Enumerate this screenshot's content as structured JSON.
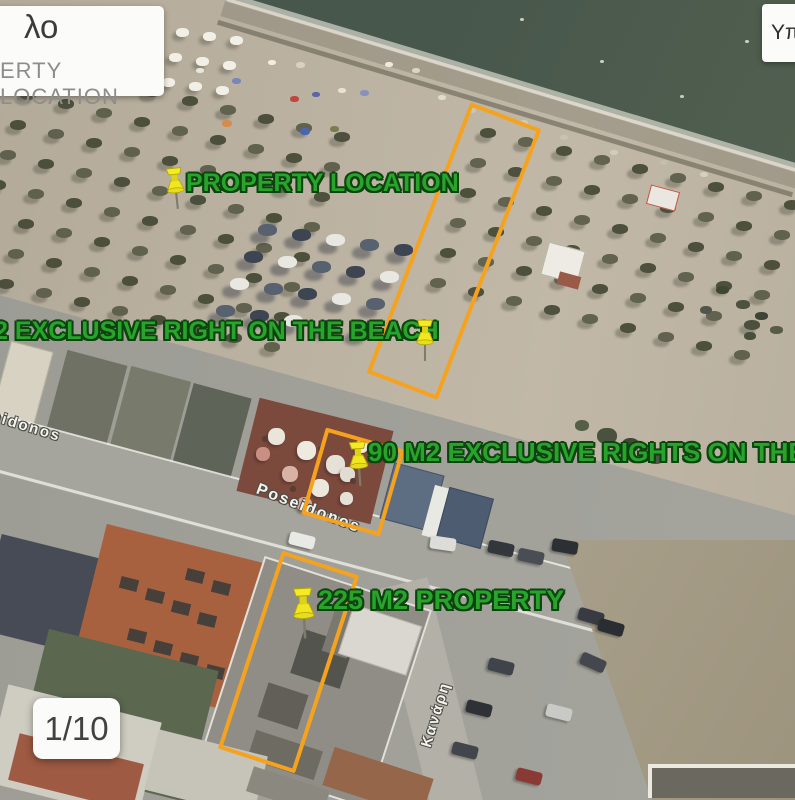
{
  "overlays": {
    "caption_box": {
      "line1": "λο",
      "line2": "ERTY LOCATION"
    },
    "legend_box": {
      "text": "Υπ"
    },
    "pager": {
      "text": "1/10"
    }
  },
  "annotations": {
    "accent_color": "#f5a31f",
    "text_color": "#28a32c",
    "labels": [
      {
        "text": "PROPERTY LOCATION"
      },
      {
        "text": "2 EXCLUSIVE RIGHT ON THE BEACH"
      },
      {
        "text": "90 M2 EXCLUSIVE RIGHTS ON THE"
      },
      {
        "text": "225 M2 PROPERTY"
      }
    ],
    "pins": [
      {
        "name": "property-location-pin"
      },
      {
        "name": "beach-rights-pin"
      },
      {
        "name": "beach-bar-pin"
      },
      {
        "name": "property-pin"
      }
    ],
    "boundary_boxes": [
      {
        "name": "beach-exclusive-area-box"
      },
      {
        "name": "beach-bar-area-box"
      },
      {
        "name": "property-area-box"
      }
    ]
  },
  "map": {
    "streets": [
      {
        "text": "Poseidonos"
      },
      {
        "text": "Poseidonos"
      },
      {
        "text": "Κανάρη"
      }
    ]
  }
}
